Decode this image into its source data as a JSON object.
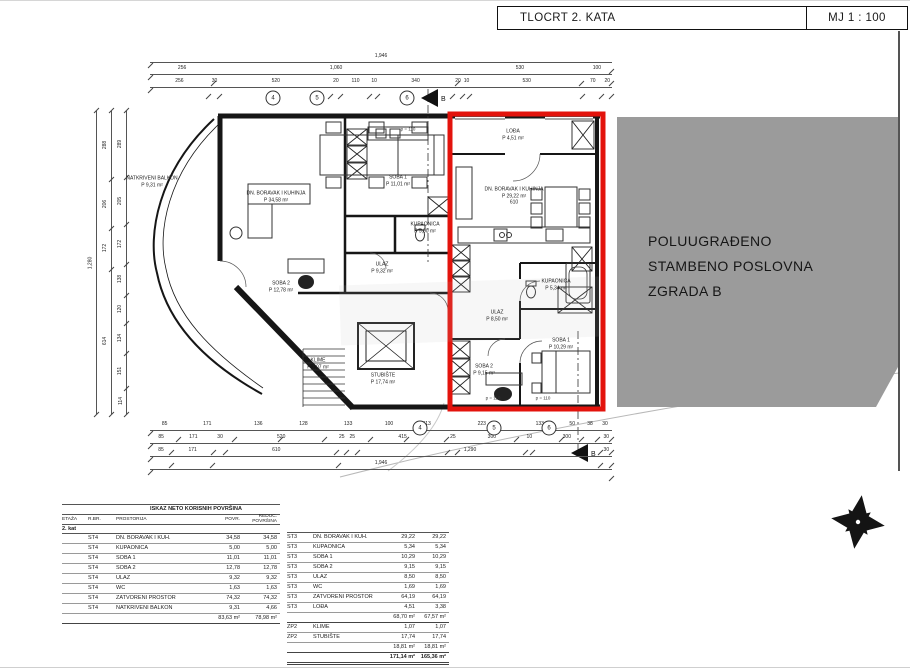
{
  "title_block": {
    "title": "TLOCRT 2. KATA",
    "scale": "MJ 1 : 100"
  },
  "neighbor": {
    "lines": [
      "POLUUGRAĐENO",
      "STAMBENO POSLOVNA",
      "ZGRADA B"
    ],
    "fill": "#9b9b9b"
  },
  "colors": {
    "highlight_red": "#e3130c",
    "line": "#161616"
  },
  "plan": {
    "section_label": "B",
    "parapet_label": "p = 110",
    "grid_bubbles_top": [
      "4",
      "5",
      "6"
    ],
    "grid_bubbles_bottom": [
      "4",
      "5",
      "6"
    ],
    "rooms": {
      "balkon": {
        "name": "NATKRIVENI BALKON",
        "area": "P 9,31 m²"
      },
      "dnevni_st4": {
        "name": "DN. BORAVAK I KUHINJA",
        "area": "P 34,58 m²"
      },
      "soba1_st4": {
        "name": "SOBA 1",
        "area": "P 11,01 m²"
      },
      "soba2_st4": {
        "name": "SOBA 2",
        "area": "P 12,78 m²"
      },
      "kupaonica_st4": {
        "name": "KUPAONICA",
        "area": "P 5,00 m²"
      },
      "ulaz_st4": {
        "name": "ULAZ",
        "area": "P 9,32 m²"
      },
      "stubiste": {
        "name": "STUBIŠTE",
        "area": "P 17,74 m²"
      },
      "klime": {
        "name": "KLIME",
        "area": "P 1,07 m²"
      },
      "loda": {
        "name": "LOĐA",
        "area": "P 4,51 m²"
      },
      "dnevni_st3": {
        "name": "DN. BORAVAK I KUHINJA",
        "area": "P 29,22 m²",
        "dim": "610"
      },
      "kupaonica_st3": {
        "name": "KUPAONICA",
        "area": "P 5,34 m²"
      },
      "ulaz_st3": {
        "name": "ULAZ",
        "area": "P 8,50 m²"
      },
      "soba1_st3": {
        "name": "SOBA 1",
        "area": "P 10,29 m²"
      },
      "soba2_st3": {
        "name": "SOBA 2",
        "area": "P 9,15 m²"
      }
    },
    "dimensions": {
      "top1": [
        "1,946"
      ],
      "top2": [
        "256",
        "1,060",
        "530",
        "100"
      ],
      "top3": [
        "256",
        "30",
        "520",
        "20",
        "110",
        "10",
        "340",
        "20",
        "10",
        "530",
        "70",
        "20"
      ],
      "bottom1": [
        "85",
        "171",
        "136",
        "128",
        "133",
        "100",
        "113",
        "223",
        "133",
        "50",
        "38",
        "30"
      ],
      "bottom2": [
        "85",
        "171",
        "30",
        "520",
        "25",
        "25",
        "415",
        "25",
        "300",
        "10",
        "300",
        "30"
      ],
      "bottom3": [
        "85",
        "171",
        "610",
        "1,290",
        "30"
      ],
      "bottom4": [
        "1,946"
      ],
      "left1": [
        "1,280"
      ],
      "left2": [
        "288",
        "206",
        "172",
        "614"
      ],
      "left3": [
        "289",
        "205",
        "172",
        "138",
        "120",
        "134",
        "151",
        "114"
      ]
    }
  },
  "table": {
    "title": "ISKAZ NETO KORISNIH POVRŠINA",
    "headers": {
      "etaza": "ETAŽA",
      "rbr": "R.BR.",
      "prostorija": "PROSTORIJA",
      "povr": "POVR.",
      "reduc": "REDUC. POVRŠINA"
    },
    "floor_label": "2. kat",
    "st4_rows": [
      [
        "ST4",
        "DN. BORAVAK I KUH.",
        "34,58",
        "34,58"
      ],
      [
        "ST4",
        "KUPAONICA",
        "5,00",
        "5,00"
      ],
      [
        "ST4",
        "SOBA 1",
        "11,01",
        "11,01"
      ],
      [
        "ST4",
        "SOBA 2",
        "12,78",
        "12,78"
      ],
      [
        "ST4",
        "ULAZ",
        "9,32",
        "9,32"
      ],
      [
        "ST4",
        "WC",
        "1,63",
        "1,63"
      ],
      [
        "ST4",
        "ZATVORENI PROSTOR",
        "74,32",
        "74,32"
      ],
      [
        "ST4",
        "NATKRIVENI BALKON",
        "9,31",
        "4,66"
      ]
    ],
    "st4_total": {
      "povr": "83,63 m²",
      "reduc": "78,98 m²"
    },
    "st3_rows": [
      [
        "ST3",
        "DN. BORAVAK I KUH.",
        "29,22",
        "29,22"
      ],
      [
        "ST3",
        "KUPAONICA",
        "5,34",
        "5,34"
      ],
      [
        "ST3",
        "SOBA 1",
        "10,29",
        "10,29"
      ],
      [
        "ST3",
        "SOBA 2",
        "9,15",
        "9,15"
      ],
      [
        "ST3",
        "ULAZ",
        "8,50",
        "8,50"
      ],
      [
        "ST3",
        "WC",
        "1,69",
        "1,69"
      ],
      [
        "ST3",
        "ZATVORENI PROSTOR",
        "64,19",
        "64,19"
      ],
      [
        "ST3",
        "LOĐA",
        "4,51",
        "3,38"
      ]
    ],
    "st3_total": {
      "povr": "68,70 m²",
      "reduc": "67,57 m²"
    },
    "zp2_rows": [
      [
        "ZP2",
        "KLIME",
        "1,07",
        "1,07"
      ],
      [
        "ZP2",
        "STUBIŠTE",
        "17,74",
        "17,74"
      ]
    ],
    "zp2_total": {
      "povr": "18,81 m²",
      "reduc": "18,81 m²"
    },
    "grand_total": {
      "povr": "171,14 m²",
      "reduc": "165,36 m²"
    }
  }
}
